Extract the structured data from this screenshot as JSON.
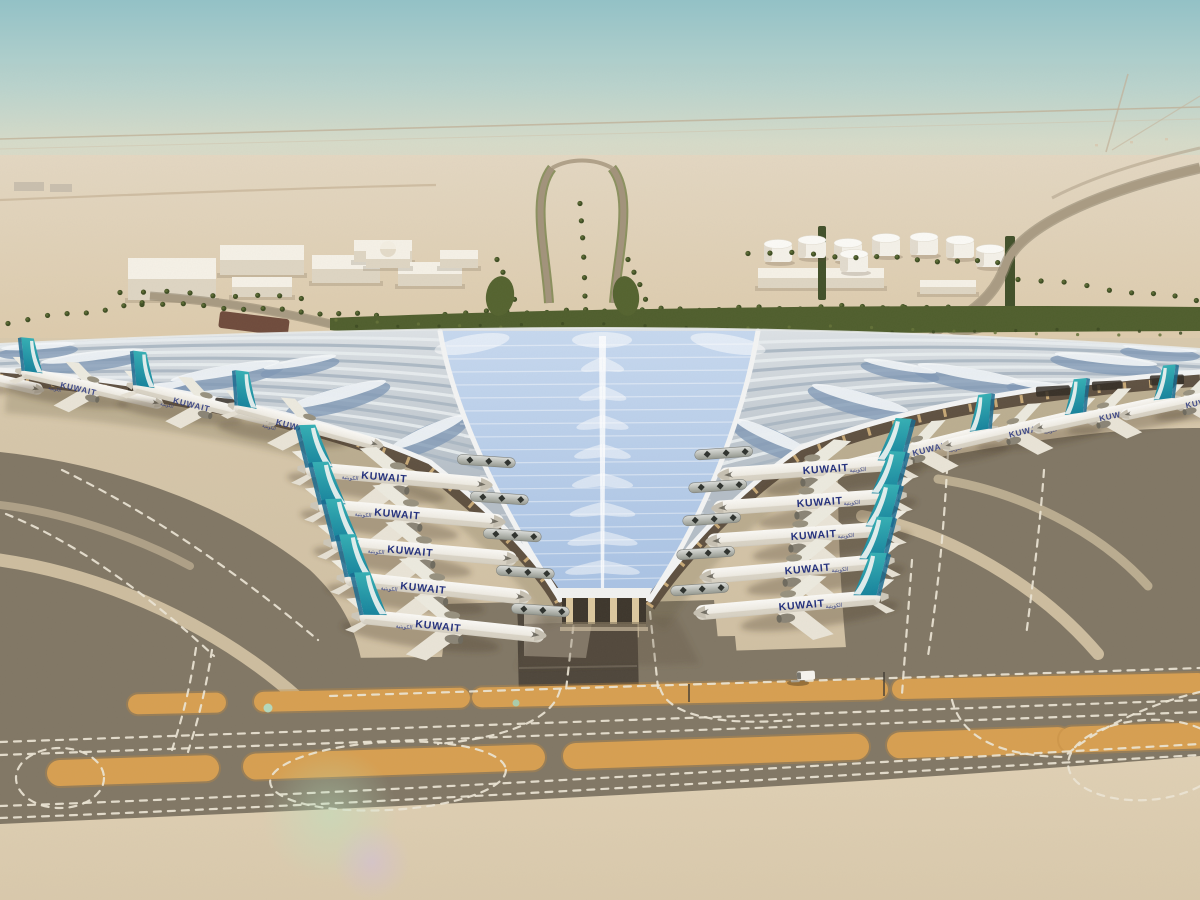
{
  "meta": {
    "description": "Aerial architectural rendering of the new Kuwait International Airport trefoil terminal: a sweeping silver canopy with a blue solar-glass central vault, Kuwait Airways aircraft parked at gates on both sides, desert landscape, palm-lined access roads, fuel tanks and warehouses in the background, and dark taxiways with dashed white markings and orange strips in the foreground",
    "type": "3D architectural rendering"
  },
  "labels": {
    "airline": "KUWAIT",
    "airline_ar": "الكويتية"
  },
  "palette": {
    "skyTop": "#93c1c6",
    "skyMid": "#b9d3cd",
    "skyHaze": "#e0d8c4",
    "sandFar": "#e4d6bf",
    "sandMid": "#dccaab",
    "sandNear": "#cdbd9f",
    "apron": "#d0c1a5",
    "asphalt": "#817765",
    "asphaltDeep": "#6f6656",
    "pitDark": "#4e463b",
    "orange": "#d79f51",
    "orangeDeep": "#bf8a3e",
    "mark": "#ece5d5",
    "green": "#4f5e2d",
    "greenLight": "#6b7a3f",
    "palm": "#3e4d23",
    "roofLight": "#e2e6e9",
    "roofMid": "#bcc5cd",
    "roofBlue": "#8098b6",
    "roofWhite": "#f3f4f4",
    "glassTop": "#c6d8ef",
    "glassBottom": "#a8c2e4",
    "buildingTop": "#f5f1e7",
    "buildingFront": "#ded5c3",
    "road": "#a69880",
    "roadDark": "#8b7f69",
    "tailTeal": "#35b0b5",
    "tailTealDeep": "#14809b",
    "titleBlue": "#23307d",
    "planeWhite": "#f7f5f0",
    "planeShade": "#cfc9bb",
    "metal": "#c3c6c2",
    "shadow": "rgba(74,60,44,0.32)",
    "gold": "#c9984e"
  },
  "scene": {
    "aircraft": {
      "inner_left": [
        {
          "x": 398,
          "y": 477,
          "r": 5
        },
        {
          "x": 411,
          "y": 514,
          "r": 5
        },
        {
          "x": 424,
          "y": 551,
          "r": 5
        },
        {
          "x": 437,
          "y": 588,
          "r": 6
        },
        {
          "x": 452,
          "y": 626,
          "r": 6
        }
      ],
      "inner_right": [
        {
          "x": 812,
          "y": 469,
          "r": -4
        },
        {
          "x": 806,
          "y": 502,
          "r": -4
        },
        {
          "x": 800,
          "y": 535,
          "r": -4
        },
        {
          "x": 794,
          "y": 569,
          "r": -5
        },
        {
          "x": 788,
          "y": 605,
          "r": -5
        }
      ],
      "pier_left": [
        {
          "x": -28,
          "y": 374,
          "r": 13,
          "s": 0.78
        },
        {
          "x": 92,
          "y": 388,
          "r": 13,
          "s": 0.78
        },
        {
          "x": 205,
          "y": 404,
          "r": 14,
          "s": 0.8
        },
        {
          "x": 308,
          "y": 426,
          "r": 15,
          "s": 0.82
        }
      ],
      "pier_right": [
        {
          "x": 918,
          "y": 448,
          "r": -14,
          "s": 0.82
        },
        {
          "x": 1014,
          "y": 430,
          "r": -13,
          "s": 0.8
        },
        {
          "x": 1104,
          "y": 414,
          "r": -12,
          "s": 0.78
        },
        {
          "x": 1190,
          "y": 401,
          "r": -12,
          "s": 0.76
        }
      ]
    },
    "orange_rows": [
      {
        "y0": 707,
        "slope": -0.02,
        "h": 20,
        "segs": [
          [
            138,
            216
          ],
          [
            264,
            460
          ],
          [
            482,
            878
          ],
          [
            902,
            1198
          ]
        ]
      },
      {
        "y0": 775,
        "slope": -0.033,
        "h": 26,
        "segs": [
          [
            60,
            206
          ],
          [
            256,
            532
          ],
          [
            576,
            856
          ],
          [
            900,
            1058
          ],
          [
            1072,
            1198
          ]
        ]
      }
    ],
    "palm_rows": [
      {
        "x1": 445,
        "y1": 313,
        "x2": 900,
        "y2": 306,
        "n": 24
      },
      {
        "x1": 905,
        "y1": 306,
        "x2": 1195,
        "y2": 324,
        "n": 15
      },
      {
        "x1": 142,
        "y1": 303,
        "x2": 438,
        "y2": 319,
        "n": 16
      },
      {
        "x1": 8,
        "y1": 322,
        "x2": 140,
        "y2": 304,
        "n": 8
      },
      {
        "x1": 120,
        "y1": 291,
        "x2": 300,
        "y2": 298,
        "n": 9
      },
      {
        "x1": 748,
        "y1": 252,
        "x2": 1000,
        "y2": 263,
        "n": 13
      },
      {
        "x1": 1018,
        "y1": 278,
        "x2": 1195,
        "y2": 300,
        "n": 9
      },
      {
        "x1": 497,
        "y1": 258,
        "x2": 512,
        "y2": 300,
        "n": 4
      },
      {
        "x1": 628,
        "y1": 258,
        "x2": 643,
        "y2": 300,
        "n": 4
      },
      {
        "x1": 580,
        "y1": 202,
        "x2": 582,
        "y2": 295,
        "n": 6
      }
    ],
    "tanks": [
      [
        778,
        253
      ],
      [
        812,
        249
      ],
      [
        848,
        252
      ],
      [
        886,
        247
      ],
      [
        924,
        246
      ],
      [
        960,
        249
      ],
      [
        990,
        258
      ],
      [
        854,
        263
      ]
    ],
    "buildings": [
      {
        "x": 128,
        "y": 258,
        "w": 88,
        "h": 42
      },
      {
        "x": 220,
        "y": 245,
        "w": 84,
        "h": 30
      },
      {
        "x": 232,
        "y": 277,
        "w": 60,
        "h": 20
      },
      {
        "x": 312,
        "y": 255,
        "w": 68,
        "h": 28
      },
      {
        "x": 354,
        "y": 240,
        "w": 58,
        "h": 22
      },
      {
        "x": 398,
        "y": 262,
        "w": 64,
        "h": 24
      },
      {
        "x": 440,
        "y": 250,
        "w": 38,
        "h": 18
      },
      {
        "x": 366,
        "y": 250,
        "w": 44,
        "h": 18
      },
      {
        "x": 758,
        "y": 268,
        "w": 126,
        "h": 20
      },
      {
        "x": 920,
        "y": 280,
        "w": 56,
        "h": 14
      }
    ],
    "dome": {
      "cx": 388,
      "cy": 249,
      "r": 8
    },
    "hedges": [
      [
        818,
        226,
        8,
        74
      ],
      [
        1005,
        236,
        10,
        78
      ]
    ],
    "distant": [
      [
        14,
        182,
        30,
        9
      ],
      [
        50,
        184,
        22,
        8
      ]
    ]
  }
}
